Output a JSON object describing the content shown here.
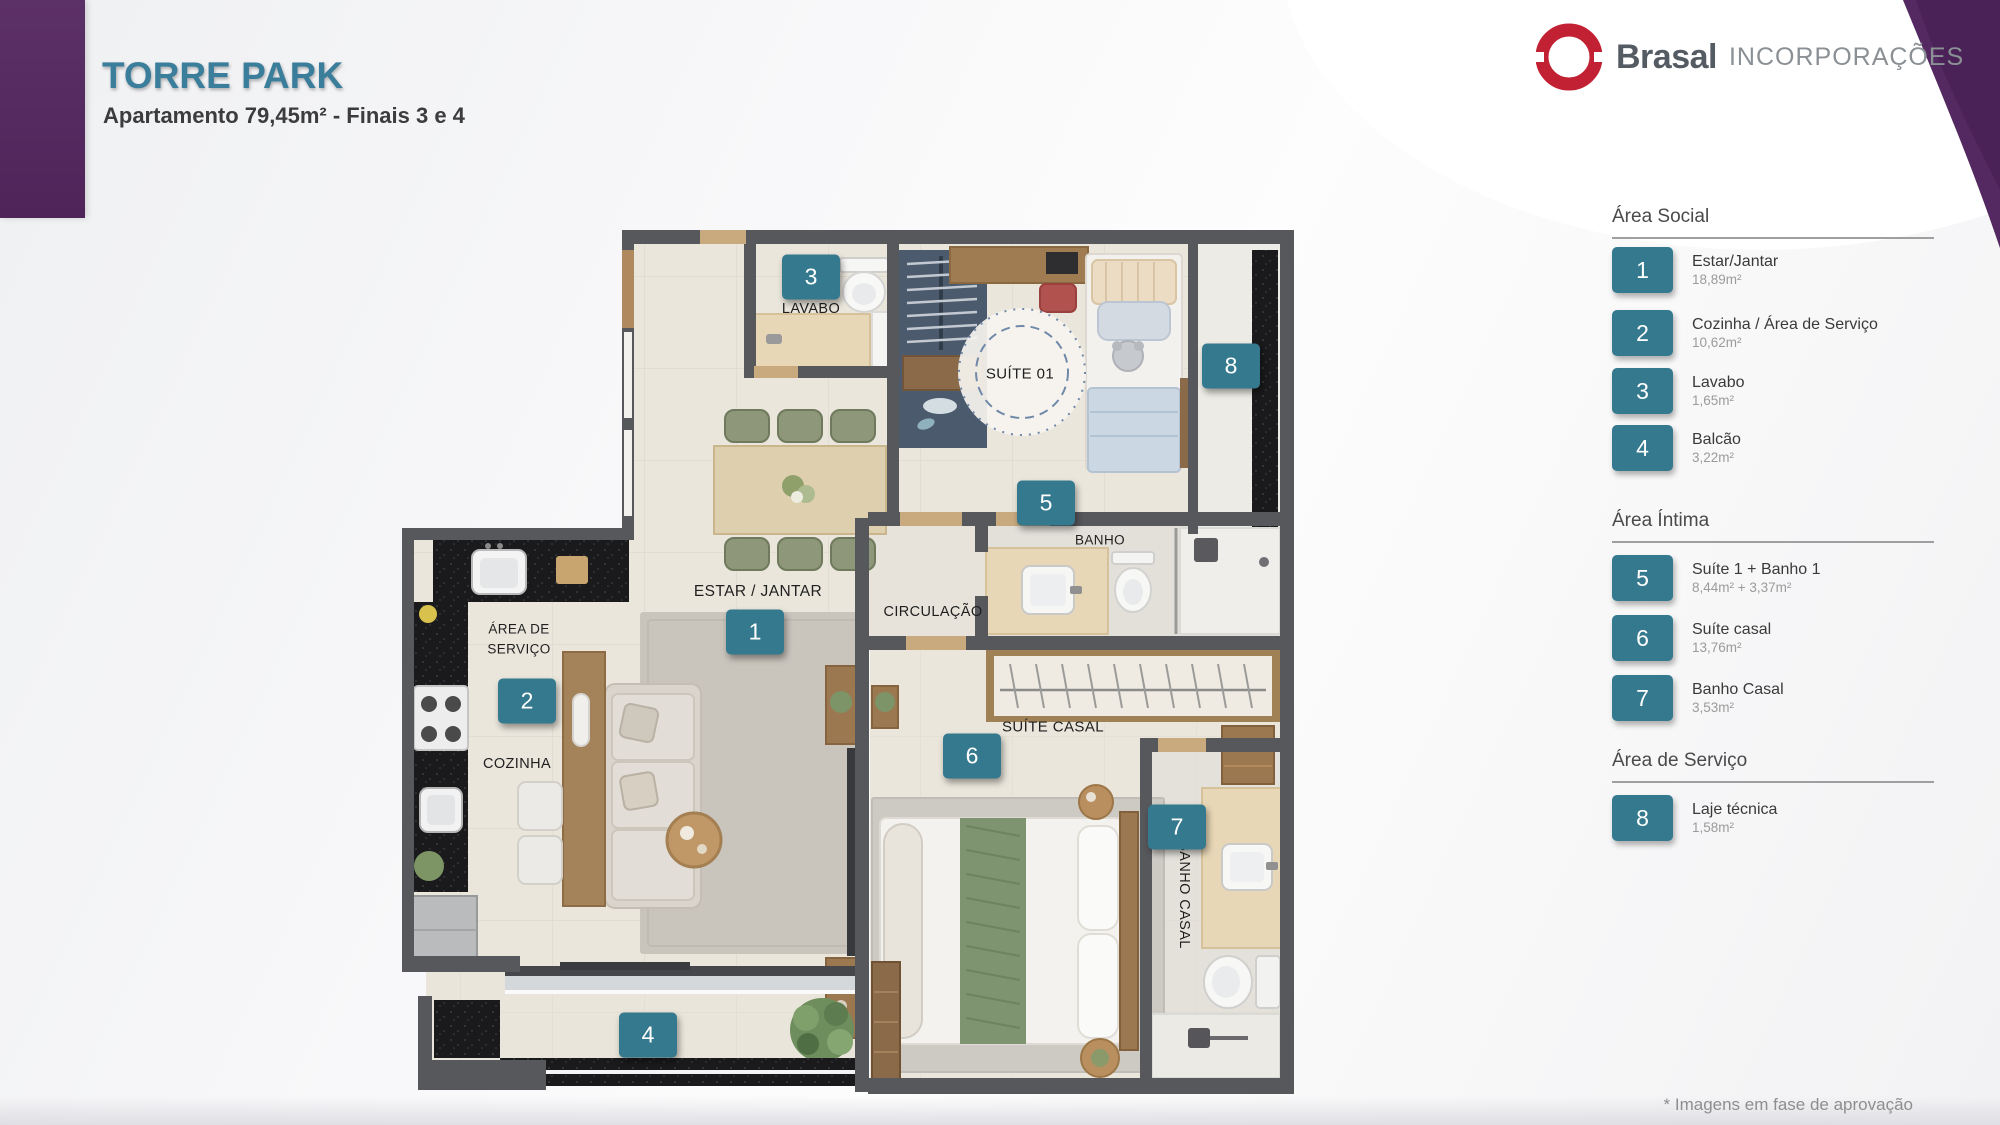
{
  "header": {
    "title": "TORRE PARK",
    "subtitle": "Apartamento 79,45m² - Finais 3 e 4"
  },
  "brand": {
    "name": "Brasal",
    "suffix": "INCORPORAÇÕES"
  },
  "colors": {
    "accent_teal": "#35798F",
    "title_teal": "#3B7E9C",
    "purple": "#542A60",
    "logo_red": "#C22033"
  },
  "legend": {
    "sections": [
      {
        "title": "Área Social",
        "items": [
          {
            "num": "1",
            "label": "Estar/Jantar",
            "area": "18,89m²"
          },
          {
            "num": "2",
            "label": "Cozinha / Área de Serviço",
            "area": "10,62m²"
          },
          {
            "num": "3",
            "label": "Lavabo",
            "area": "1,65m²"
          },
          {
            "num": "4",
            "label": "Balcão",
            "area": "3,22m²"
          }
        ]
      },
      {
        "title": "Área Íntima",
        "items": [
          {
            "num": "5",
            "label": "Suíte 1 + Banho 1",
            "area": "8,44m² + 3,37m²"
          },
          {
            "num": "6",
            "label": "Suíte casal",
            "area": "13,76m²"
          },
          {
            "num": "7",
            "label": "Banho Casal",
            "area": "3,53m²"
          }
        ]
      },
      {
        "title": "Área de Serviço",
        "items": [
          {
            "num": "8",
            "label": "Laje técnica",
            "area": "1,58m²"
          }
        ]
      }
    ]
  },
  "plan": {
    "markers": [
      {
        "num": "1"
      },
      {
        "num": "2"
      },
      {
        "num": "3"
      },
      {
        "num": "4"
      },
      {
        "num": "5"
      },
      {
        "num": "6"
      },
      {
        "num": "7"
      },
      {
        "num": "8"
      }
    ],
    "labels": [
      {
        "text": "LAVABO"
      },
      {
        "text": "SUÍTE 01"
      },
      {
        "text": "ESTAR / JANTAR"
      },
      {
        "text": "CIRCULAÇÃO"
      },
      {
        "text": "ÁREA DE"
      },
      {
        "text": "SERVIÇO"
      },
      {
        "text": "COZINHA"
      },
      {
        "text": "BANHO"
      },
      {
        "text": "SUÍTE CASAL"
      },
      {
        "text": "BANHO CASAL"
      }
    ]
  },
  "footer": {
    "note": "* Imagens em fase de aprovação"
  }
}
